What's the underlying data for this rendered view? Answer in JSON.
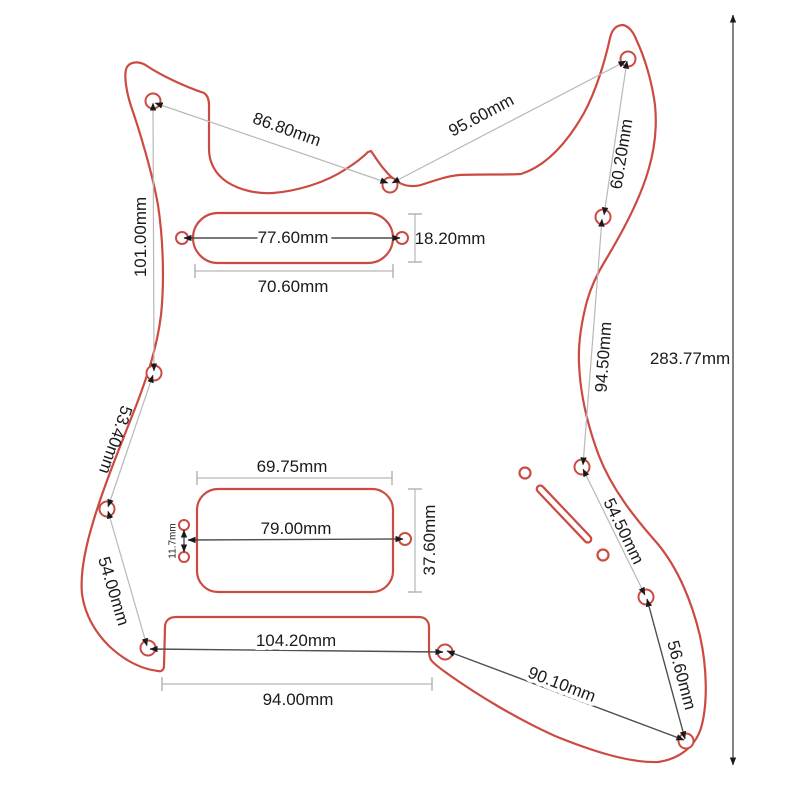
{
  "diagram": {
    "colors": {
      "outline_red": "#cb4a42",
      "dim_line_light": "#b8b8b8",
      "dim_line_dark": "#4f4f4f",
      "text": "#1b1b1b"
    },
    "overall": {
      "length": "283.77mm"
    },
    "edge_dims": {
      "left_horn_to_neck_hole": "86.80mm",
      "neck_hole_to_right_horn": "95.60mm",
      "upper_left_edge": "101.00mm",
      "left_mid_edge": "53.40mm",
      "left_lower_edge": "54.00mm",
      "right_horn_edge": "60.20mm",
      "right_upper_edge": "94.50mm",
      "right_mid_edge": "54.50mm",
      "right_lower_edge": "56.60mm",
      "bottom_diagonal": "90.10mm",
      "bottom_hole_span": "104.20mm",
      "bridge_cutout_width": "94.00mm"
    },
    "neck_pickup": {
      "screw_span": "77.60mm",
      "cutout_width": "70.60mm",
      "cutout_height": "18.20mm"
    },
    "humbucker": {
      "cutout_width": "69.75mm",
      "screw_span": "79.00mm",
      "cutout_height": "37.60mm",
      "screw_pair_gap": "11.7mm"
    }
  }
}
